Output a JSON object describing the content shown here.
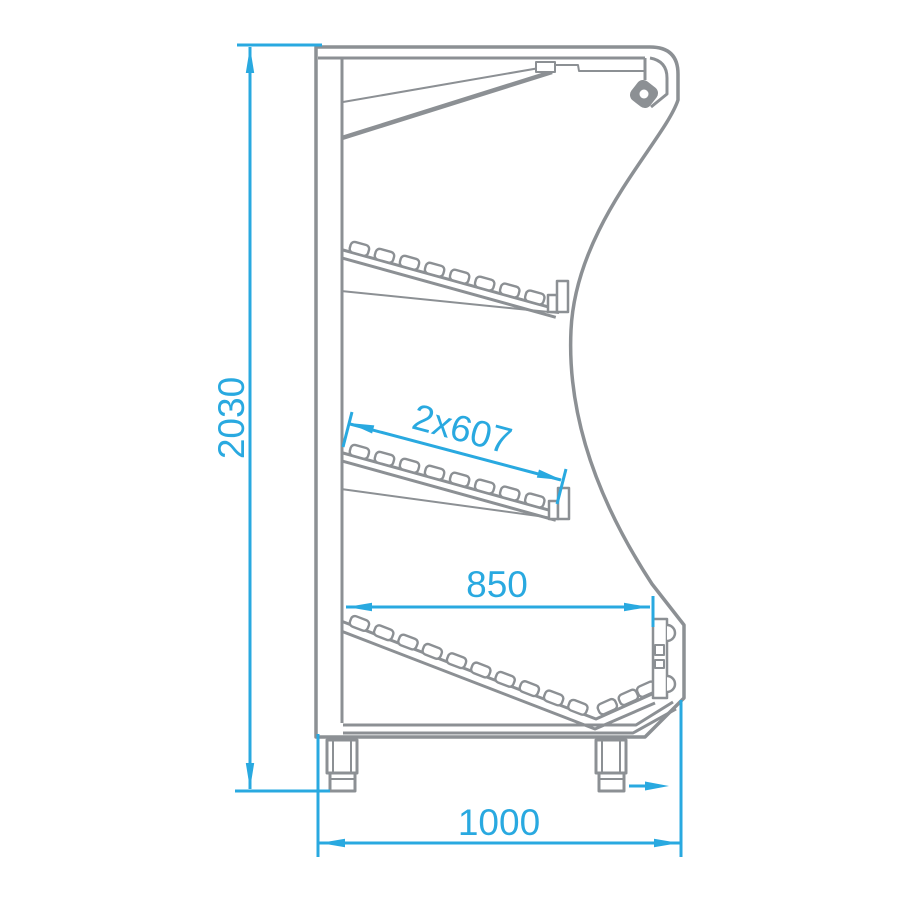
{
  "drawing": {
    "colors": {
      "line": "#8C9094",
      "dimension": "#29A9E0",
      "background": "#FFFFFF"
    },
    "dimensions": {
      "overall_height": {
        "label": "2030",
        "orientation": "vertical"
      },
      "shelf_depth": {
        "label": "2x607",
        "orientation": "aligned-to-shelf"
      },
      "front_width": {
        "label": "850",
        "orientation": "horizontal"
      },
      "overall_depth": {
        "label": "1000",
        "orientation": "horizontal"
      }
    },
    "icons": {
      "airflow": "airflow-arrow-icon"
    }
  }
}
